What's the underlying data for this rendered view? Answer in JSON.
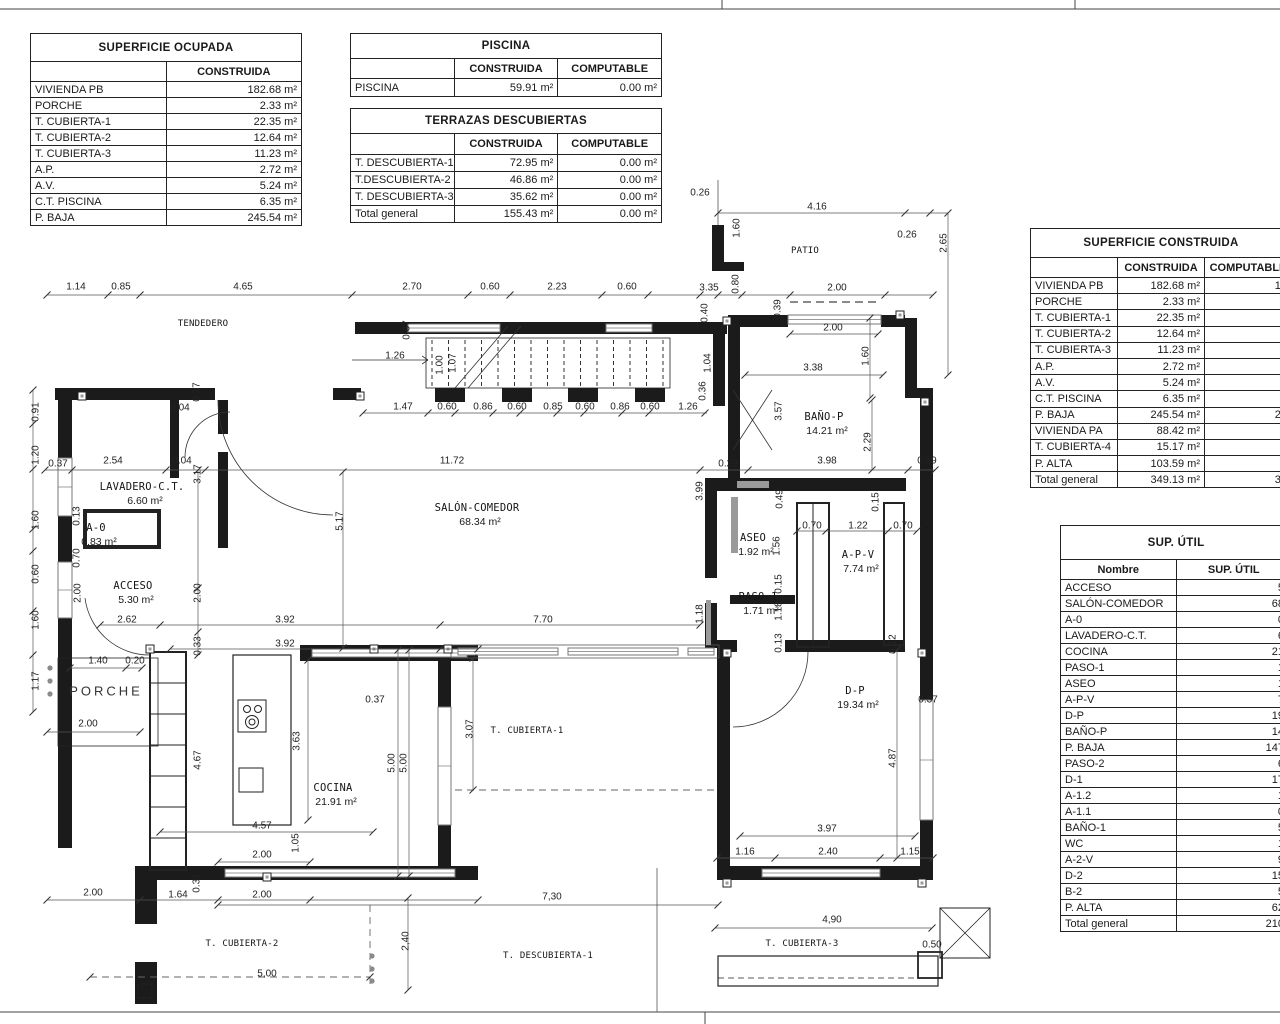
{
  "tables": {
    "superficie_ocupada": {
      "title": "SUPERFICIE OCUPADA",
      "columns": [
        "",
        "CONSTRUIDA"
      ],
      "rows": [
        [
          "VIVIENDA PB",
          "182.68 m²"
        ],
        [
          "PORCHE",
          "2.33 m²"
        ],
        [
          "T.  CUBIERTA-1",
          "22.35 m²"
        ],
        [
          "T. CUBIERTA-2",
          "12.64 m²"
        ],
        [
          "T. CUBIERTA-3",
          "11.23 m²"
        ],
        [
          "A.P.",
          "2.72 m²"
        ],
        [
          "A.V.",
          "5.24 m²"
        ],
        [
          "C.T. PISCINA",
          "6.35 m²"
        ],
        [
          "P. BAJA",
          "245.54 m²"
        ]
      ]
    },
    "piscina": {
      "title": "PISCINA",
      "columns": [
        "",
        "CONSTRUIDA",
        "COMPUTABLE"
      ],
      "rows": [
        [
          "PISCINA",
          "59.91 m²",
          "0.00 m²"
        ]
      ]
    },
    "terrazas_descubiertas": {
      "title": "TERRAZAS DESCUBIERTAS",
      "columns": [
        "",
        "CONSTRUIDA",
        "COMPUTABLE"
      ],
      "rows": [
        [
          "T. DESCUBIERTA-1",
          "72.95 m²",
          "0.00 m²"
        ],
        [
          "T.DESCUBIERTA-2",
          "46.86 m²",
          "0.00 m²"
        ],
        [
          "T. DESCUBIERTA-3",
          "35.62 m²",
          "0.00 m²"
        ],
        [
          "Total general",
          "155.43 m²",
          "0.00 m²"
        ]
      ]
    },
    "superficie_construida": {
      "title": "SUPERFICIE CONSTRUIDA",
      "columns": [
        "",
        "CONSTRUIDA",
        "COMPUTABLE"
      ],
      "rows": [
        [
          "VIVIENDA PB",
          "182.68 m²",
          "18"
        ],
        [
          "PORCHE",
          "2.33 m²",
          ""
        ],
        [
          "T.  CUBIERTA-1",
          "22.35 m²",
          "1"
        ],
        [
          "T. CUBIERTA-2",
          "12.64 m²",
          ""
        ],
        [
          "T. CUBIERTA-3",
          "11.23 m²",
          ""
        ],
        [
          "A.P.",
          "2.72 m²",
          ""
        ],
        [
          "A.V.",
          "5.24 m²",
          ""
        ],
        [
          "C.T. PISCINA",
          "6.35 m²",
          ""
        ],
        [
          "P. BAJA",
          "245.54 m²",
          "21"
        ],
        [
          "VIVIENDA  PA",
          "88.42 m²",
          "8"
        ],
        [
          "T. CUBIERTA-4",
          "15.17 m²",
          ""
        ],
        [
          "P. ALTA",
          "103.59 m²",
          "9"
        ],
        [
          "Total general",
          "349.13 m²",
          "31"
        ]
      ]
    },
    "sup_util": {
      "title": "SUP. ÚTIL",
      "columns": [
        "Nombre",
        "SUP. ÚTIL"
      ],
      "rows": [
        [
          "ACCESO",
          "5."
        ],
        [
          "SALÓN-COMEDOR",
          "68."
        ],
        [
          "A-0",
          "0."
        ],
        [
          "LAVADERO-C.T.",
          "6."
        ],
        [
          "COCINA",
          "21."
        ],
        [
          "PASO-1",
          "1."
        ],
        [
          "ASEO",
          "1."
        ],
        [
          "A-P-V",
          "7."
        ],
        [
          "D-P",
          "19."
        ],
        [
          "BAÑO-P",
          "14."
        ],
        [
          "P. BAJA",
          "147."
        ],
        [
          "PASO-2",
          "6."
        ],
        [
          "D-1",
          "17."
        ],
        [
          "A-1.2",
          "1."
        ],
        [
          "A-1.1",
          "0."
        ],
        [
          "BAÑO-1",
          "5."
        ],
        [
          "WC",
          "1."
        ],
        [
          "A-2-V",
          "9."
        ],
        [
          "D-2",
          "15."
        ],
        [
          "B-2",
          "5."
        ],
        [
          "P. ALTA",
          "62."
        ],
        [
          "Total general",
          "210."
        ]
      ]
    }
  },
  "plan": {
    "rooms": [
      {
        "n": "TENDEDERO",
        "x": 203,
        "y": 324,
        "sm": true
      },
      {
        "n": "PATIO",
        "x": 805,
        "y": 251,
        "sm": true
      },
      {
        "n": "LAVADERO-C.T.",
        "a": "6.60 m²",
        "x": 142,
        "y": 487
      },
      {
        "n": "A-0",
        "a": "0.83 m²",
        "x": 96,
        "y": 528
      },
      {
        "n": "ACCESO",
        "a": "5.30 m²",
        "x": 133,
        "y": 586
      },
      {
        "n": "PORCHE",
        "x": 106,
        "y": 691,
        "plain": true
      },
      {
        "n": "SALÓN-COMEDOR",
        "a": "68.34 m²",
        "x": 477,
        "y": 508
      },
      {
        "n": "COCINA",
        "a": "21.91 m²",
        "x": 333,
        "y": 788
      },
      {
        "n": "BAÑO-P",
        "a": "14.21 m²",
        "x": 824,
        "y": 417
      },
      {
        "n": "ASEO",
        "a": "1.92 m²",
        "x": 753,
        "y": 538
      },
      {
        "n": "A-P-V",
        "a": "7.74 m²",
        "x": 858,
        "y": 555
      },
      {
        "n": "PASO-1",
        "a": "1.71 m²",
        "x": 758,
        "y": 597
      },
      {
        "n": "D-P",
        "a": "19.34 m²",
        "x": 855,
        "y": 691
      },
      {
        "n": "T. CUBIERTA-1",
        "x": 527,
        "y": 731,
        "sm": true
      },
      {
        "n": "T. CUBIERTA-2",
        "x": 242,
        "y": 944,
        "sm": true
      },
      {
        "n": "T. DESCUBIERTA-1",
        "x": 548,
        "y": 956,
        "sm": true
      },
      {
        "n": "T. CUBIERTA-3",
        "x": 802,
        "y": 944,
        "sm": true
      }
    ],
    "dims_h": [
      {
        "t": "1.14",
        "x": 76,
        "y": 287
      },
      {
        "t": "0.85",
        "x": 121,
        "y": 287
      },
      {
        "t": "4.65",
        "x": 243,
        "y": 287
      },
      {
        "t": "2.70",
        "x": 412,
        "y": 287
      },
      {
        "t": "0.60",
        "x": 490,
        "y": 287
      },
      {
        "t": "2.23",
        "x": 557,
        "y": 287
      },
      {
        "t": "0.60",
        "x": 627,
        "y": 287
      },
      {
        "t": "3.35",
        "x": 709,
        "y": 288
      },
      {
        "t": "2.00",
        "x": 837,
        "y": 288
      },
      {
        "t": "0.26",
        "x": 700,
        "y": 193
      },
      {
        "t": "4.16",
        "x": 817,
        "y": 207
      },
      {
        "t": "0.26",
        "x": 907,
        "y": 235
      },
      {
        "t": "2.00",
        "x": 833,
        "y": 328
      },
      {
        "t": "3.38",
        "x": 813,
        "y": 368
      },
      {
        "t": "1.26",
        "x": 395,
        "y": 356
      },
      {
        "t": "0.04",
        "x": 180,
        "y": 408
      },
      {
        "t": "1.47",
        "x": 403,
        "y": 407
      },
      {
        "t": "0.60",
        "x": 447,
        "y": 407
      },
      {
        "t": "0.86",
        "x": 483,
        "y": 407
      },
      {
        "t": "0.60",
        "x": 517,
        "y": 407
      },
      {
        "t": "0.85",
        "x": 553,
        "y": 407
      },
      {
        "t": "0.60",
        "x": 585,
        "y": 407
      },
      {
        "t": "0.86",
        "x": 620,
        "y": 407
      },
      {
        "t": "0.60",
        "x": 650,
        "y": 407
      },
      {
        "t": "1.26",
        "x": 688,
        "y": 407
      },
      {
        "t": "0.37",
        "x": 58,
        "y": 464
      },
      {
        "t": "2.54",
        "x": 113,
        "y": 461
      },
      {
        "t": "0.04",
        "x": 182,
        "y": 461
      },
      {
        "t": "11.72",
        "x": 452,
        "y": 461
      },
      {
        "t": "0.29",
        "x": 728,
        "y": 464
      },
      {
        "t": "3.98",
        "x": 827,
        "y": 461
      },
      {
        "t": "0.39",
        "x": 927,
        "y": 461
      },
      {
        "t": "0.70",
        "x": 812,
        "y": 526
      },
      {
        "t": "1.22",
        "x": 858,
        "y": 526
      },
      {
        "t": "0.70",
        "x": 903,
        "y": 526
      },
      {
        "t": "2.62",
        "x": 127,
        "y": 620
      },
      {
        "t": "3.92",
        "x": 285,
        "y": 620
      },
      {
        "t": "7.70",
        "x": 543,
        "y": 620
      },
      {
        "t": "3.92",
        "x": 285,
        "y": 644
      },
      {
        "t": "1.40",
        "x": 98,
        "y": 661
      },
      {
        "t": "0.20",
        "x": 135,
        "y": 661
      },
      {
        "t": "2.00",
        "x": 88,
        "y": 724
      },
      {
        "t": "0.37",
        "x": 375,
        "y": 700
      },
      {
        "t": "0.37",
        "x": 928,
        "y": 700
      },
      {
        "t": "4.57",
        "x": 262,
        "y": 826
      },
      {
        "t": "3.97",
        "x": 827,
        "y": 829
      },
      {
        "t": "2.00",
        "x": 262,
        "y": 855
      },
      {
        "t": "1.16",
        "x": 745,
        "y": 852
      },
      {
        "t": "2.40",
        "x": 828,
        "y": 852
      },
      {
        "t": "1.15",
        "x": 910,
        "y": 852
      },
      {
        "t": "2.00",
        "x": 93,
        "y": 893
      },
      {
        "t": "1.64",
        "x": 178,
        "y": 895
      },
      {
        "t": "2.00",
        "x": 262,
        "y": 895
      },
      {
        "t": "7,30",
        "x": 552,
        "y": 897
      },
      {
        "t": "4,90",
        "x": 832,
        "y": 920
      },
      {
        "t": "5,00",
        "x": 267,
        "y": 974
      },
      {
        "t": "0.50",
        "x": 932,
        "y": 945
      }
    ],
    "dims_v": [
      {
        "t": "0.91",
        "x": 36,
        "y": 412
      },
      {
        "t": "1.20",
        "x": 36,
        "y": 455
      },
      {
        "t": "1.60",
        "x": 36,
        "y": 520
      },
      {
        "t": "0.60",
        "x": 36,
        "y": 574
      },
      {
        "t": "1.60",
        "x": 36,
        "y": 620
      },
      {
        "t": "1.17",
        "x": 36,
        "y": 681
      },
      {
        "t": "0.37",
        "x": 197,
        "y": 392
      },
      {
        "t": "0.37",
        "x": 407,
        "y": 330
      },
      {
        "t": "1.00",
        "x": 440,
        "y": 365
      },
      {
        "t": "1.07",
        "x": 453,
        "y": 363
      },
      {
        "t": "1.04",
        "x": 708,
        "y": 363
      },
      {
        "t": "0.36",
        "x": 703,
        "y": 391
      },
      {
        "t": "0.40",
        "x": 705,
        "y": 313
      },
      {
        "t": "0.39",
        "x": 778,
        "y": 309
      },
      {
        "t": "1.60",
        "x": 737,
        "y": 228
      },
      {
        "t": "0.80",
        "x": 736,
        "y": 284
      },
      {
        "t": "2.65",
        "x": 944,
        "y": 243
      },
      {
        "t": "1.60",
        "x": 866,
        "y": 356
      },
      {
        "t": "2.29",
        "x": 868,
        "y": 442
      },
      {
        "t": "3.57",
        "x": 779,
        "y": 411
      },
      {
        "t": "3.17",
        "x": 198,
        "y": 474
      },
      {
        "t": "3.99",
        "x": 700,
        "y": 491
      },
      {
        "t": "0.49",
        "x": 780,
        "y": 499
      },
      {
        "t": "0.15",
        "x": 876,
        "y": 502
      },
      {
        "t": "0.13",
        "x": 77,
        "y": 516
      },
      {
        "t": "0.70",
        "x": 77,
        "y": 558
      },
      {
        "t": "2.00",
        "x": 78,
        "y": 593
      },
      {
        "t": "2.00",
        "x": 198,
        "y": 593
      },
      {
        "t": "0.33",
        "x": 198,
        "y": 646
      },
      {
        "t": "1.56",
        "x": 777,
        "y": 546
      },
      {
        "t": "0.15",
        "x": 779,
        "y": 584
      },
      {
        "t": "1.18",
        "x": 779,
        "y": 611
      },
      {
        "t": "1.18",
        "x": 700,
        "y": 614
      },
      {
        "t": "0.13",
        "x": 779,
        "y": 643
      },
      {
        "t": "0.12",
        "x": 893,
        "y": 644
      },
      {
        "t": "5.17",
        "x": 340,
        "y": 521
      },
      {
        "t": "3.63",
        "x": 297,
        "y": 741
      },
      {
        "t": "4.67",
        "x": 198,
        "y": 760
      },
      {
        "t": "5.00",
        "x": 392,
        "y": 763
      },
      {
        "t": "5.00",
        "x": 404,
        "y": 763
      },
      {
        "t": "1.05",
        "x": 296,
        "y": 843
      },
      {
        "t": "0.31",
        "x": 197,
        "y": 883
      },
      {
        "t": "3.07",
        "x": 470,
        "y": 729
      },
      {
        "t": "4.87",
        "x": 893,
        "y": 758
      },
      {
        "t": "2,40",
        "x": 406,
        "y": 941
      }
    ]
  },
  "colors": {
    "wall": "#1b1b1b",
    "thin": "#333333",
    "dim": "#555555",
    "window_stroke": "#777777",
    "gray_fill": "#9a9a9a"
  }
}
